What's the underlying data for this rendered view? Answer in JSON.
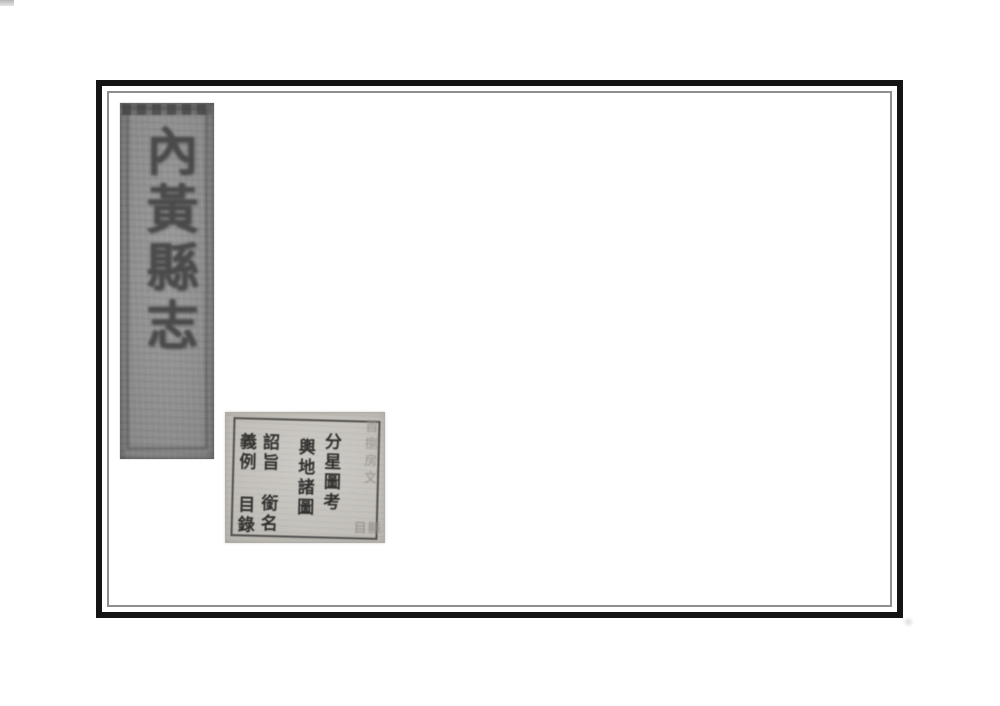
{
  "spine": {
    "title": "內黃縣志"
  },
  "toc_label": {
    "fenxing_tukao": "分星圖考",
    "yudi_zhutu": "輿地諸圖",
    "zhaozhi": "詔旨",
    "xianming": "銜名",
    "yili": "義例",
    "mulu": "目錄",
    "faint_annotation": "首捌房文",
    "faint_mark": "目縣"
  },
  "colors": {
    "page_bg": "#ffffff",
    "frame_border": "#141414",
    "inner_hairline": "#8f8f8f",
    "spine_bg": "#969696",
    "spine_ink": "#4a4a4a",
    "label_bg": "#c9c6c0",
    "label_ink": "#30302e",
    "faint_ink": "#96928c"
  }
}
